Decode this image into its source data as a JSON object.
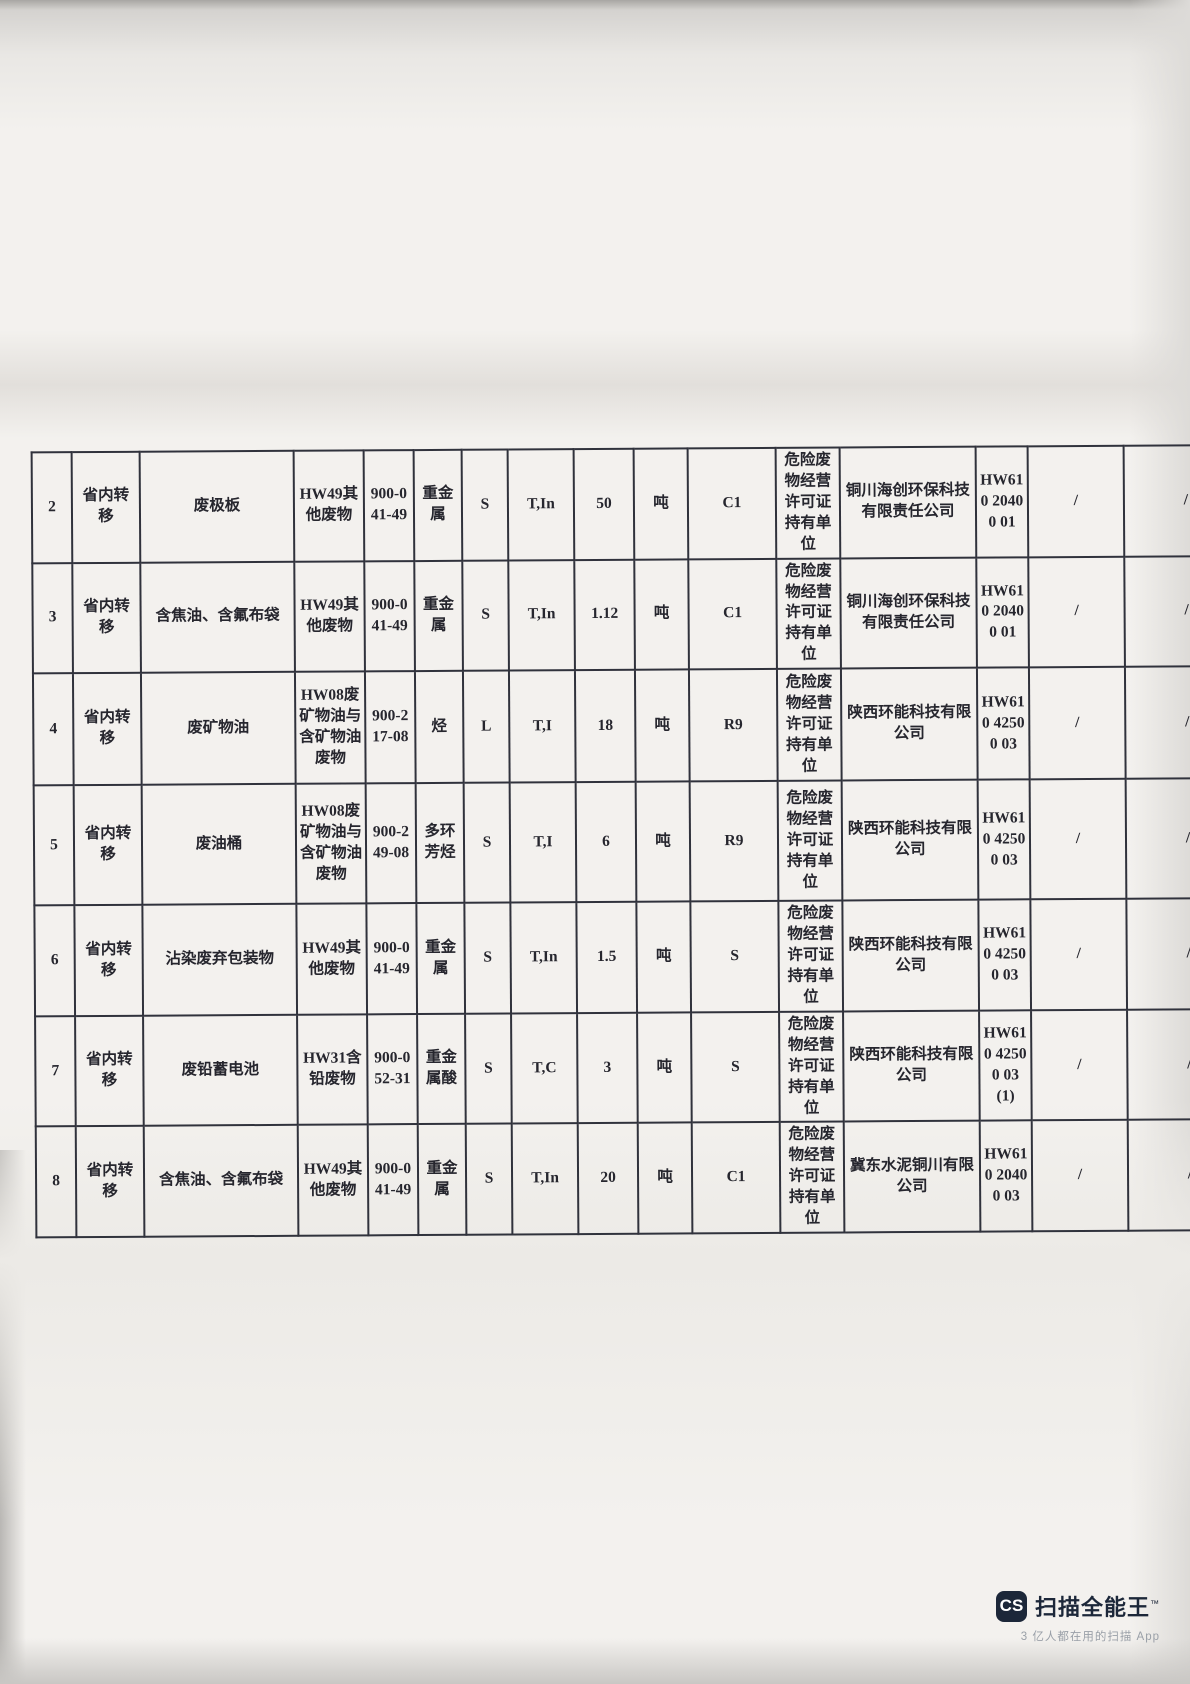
{
  "table": {
    "column_keys": [
      "no",
      "transfer_type",
      "waste_name",
      "waste_category",
      "waste_code",
      "main_component",
      "physical_state",
      "hazard_property",
      "quantity",
      "unit",
      "disposal_code",
      "holder_label",
      "holder_company",
      "permit_no",
      "note1",
      "note2"
    ],
    "rows": [
      {
        "no": "2",
        "transfer_type": "省内转移",
        "waste_name": "废极板",
        "waste_category": "HW49其他废物",
        "waste_code": "900-041-49",
        "main_component": "重金属",
        "physical_state": "S",
        "hazard_property": "T,In",
        "quantity": "50",
        "unit": "吨",
        "disposal_code": "C1",
        "holder_label": "危险废物经营许可证持有单位",
        "holder_company": "铜川海创环保科技有限责任公司",
        "permit_no": "HW610 20400 01",
        "note1": "/",
        "note2": "/"
      },
      {
        "no": "3",
        "transfer_type": "省内转移",
        "waste_name": "含焦油、含氟布袋",
        "waste_category": "HW49其他废物",
        "waste_code": "900-041-49",
        "main_component": "重金属",
        "physical_state": "S",
        "hazard_property": "T,In",
        "quantity": "1.12",
        "unit": "吨",
        "disposal_code": "C1",
        "holder_label": "危险废物经营许可证持有单位",
        "holder_company": "铜川海创环保科技有限责任公司",
        "permit_no": "HW610 20400 01",
        "note1": "/",
        "note2": "/"
      },
      {
        "no": "4",
        "transfer_type": "省内转移",
        "waste_name": "废矿物油",
        "waste_category": "HW08废矿物油与含矿物油废物",
        "waste_code": "900-217-08",
        "main_component": "烃",
        "physical_state": "L",
        "hazard_property": "T,I",
        "quantity": "18",
        "unit": "吨",
        "disposal_code": "R9",
        "holder_label": "危险废物经营许可证持有单位",
        "holder_company": "陕西环能科技有限公司",
        "permit_no": "HW610 42500 03",
        "note1": "/",
        "note2": "/"
      },
      {
        "no": "5",
        "transfer_type": "省内转移",
        "waste_name": "废油桶",
        "waste_category": "HW08废矿物油与含矿物油废物",
        "waste_code": "900-249-08",
        "main_component": "多环芳烃",
        "physical_state": "S",
        "hazard_property": "T,I",
        "quantity": "6",
        "unit": "吨",
        "disposal_code": "R9",
        "holder_label": "危险废物经营许可证持有单位",
        "holder_company": "陕西环能科技有限公司",
        "permit_no": "HW610 42500 03",
        "note1": "/",
        "note2": "/"
      },
      {
        "no": "6",
        "transfer_type": "省内转移",
        "waste_name": "沾染废弃包装物",
        "waste_category": "HW49其他废物",
        "waste_code": "900-041-49",
        "main_component": "重金属",
        "physical_state": "S",
        "hazard_property": "T,In",
        "quantity": "1.5",
        "unit": "吨",
        "disposal_code": "S",
        "holder_label": "危险废物经营许可证持有单位",
        "holder_company": "陕西环能科技有限公司",
        "permit_no": "HW610 42500 03",
        "note1": "/",
        "note2": "/"
      },
      {
        "no": "7",
        "transfer_type": "省内转移",
        "waste_name": "废铅蓄电池",
        "waste_category": "HW31含铅废物",
        "waste_code": "900-052-31",
        "main_component": "重金属酸",
        "physical_state": "S",
        "hazard_property": "T,C",
        "quantity": "3",
        "unit": "吨",
        "disposal_code": "S",
        "holder_label": "危险废物经营许可证持有单位",
        "holder_company": "陕西环能科技有限公司",
        "permit_no": "HW610 42500 03 (1)",
        "note1": "/",
        "note2": "/"
      },
      {
        "no": "8",
        "transfer_type": "省内转移",
        "waste_name": "含焦油、含氟布袋",
        "waste_category": "HW49其他废物",
        "waste_code": "900-041-49",
        "main_component": "重金属",
        "physical_state": "S",
        "hazard_property": "T,In",
        "quantity": "20",
        "unit": "吨",
        "disposal_code": "C1",
        "holder_label": "危险废物经营许可证持有单位",
        "holder_company": "冀东水泥铜川有限公司",
        "permit_no": "HW610 20400 03",
        "note1": "/",
        "note2": "/"
      }
    ]
  },
  "watermark": {
    "logo_text": "CS",
    "brand": "扫描全能王",
    "tm": "™",
    "tagline": "3 亿人都在用的扫描 App",
    "brand_color": "#1c2739"
  }
}
